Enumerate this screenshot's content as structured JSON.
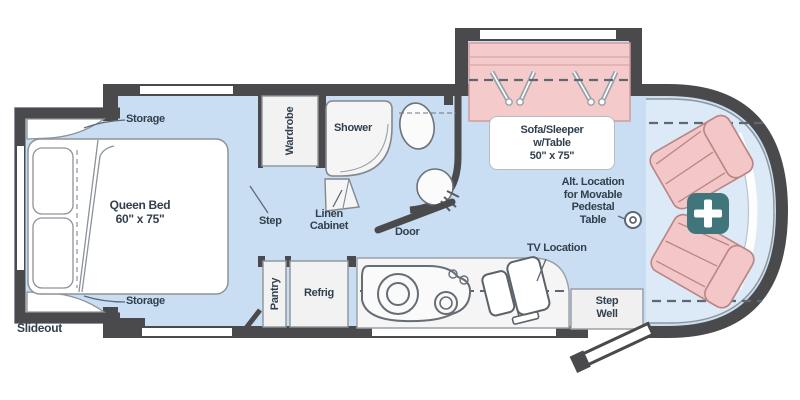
{
  "diagram_type": "rv-motorhome-floorplan",
  "colors": {
    "wall": "#4a4a4d",
    "floor": "#c9def2",
    "floor_cab": "#dce9f6",
    "furniture_white": "#f4f4f5",
    "sofa_pink": "#f5caca",
    "seat_pink": "#f3c7c7",
    "badge_teal": "#40757c",
    "text": "#32404e"
  },
  "bedroom": {
    "slideout": "Slideout",
    "storage_top": "Storage",
    "storage_bottom": "Storage",
    "bed_name": "Queen Bed",
    "bed_size": "60\" x 75\"",
    "step": "Step"
  },
  "bath": {
    "wardrobe": "Wardrobe",
    "shower": "Shower",
    "linen_line1": "Linen",
    "linen_line2": "Cabinet",
    "door": "Door"
  },
  "living": {
    "sofa_line1": "Sofa/Sleeper",
    "sofa_line2": "w/Table",
    "sofa_line3": "50\" x 75\"",
    "alt_line1": "Alt. Location",
    "alt_line2": "for Movable",
    "alt_line3": "Pedestal",
    "alt_line4": "Table",
    "tv": "TV Location"
  },
  "galley": {
    "pantry": "Pantry",
    "refrig": "Refrig",
    "stepwell_line1": "Step",
    "stepwell_line2": "Well"
  },
  "icons": {
    "plus_badge": "+"
  }
}
